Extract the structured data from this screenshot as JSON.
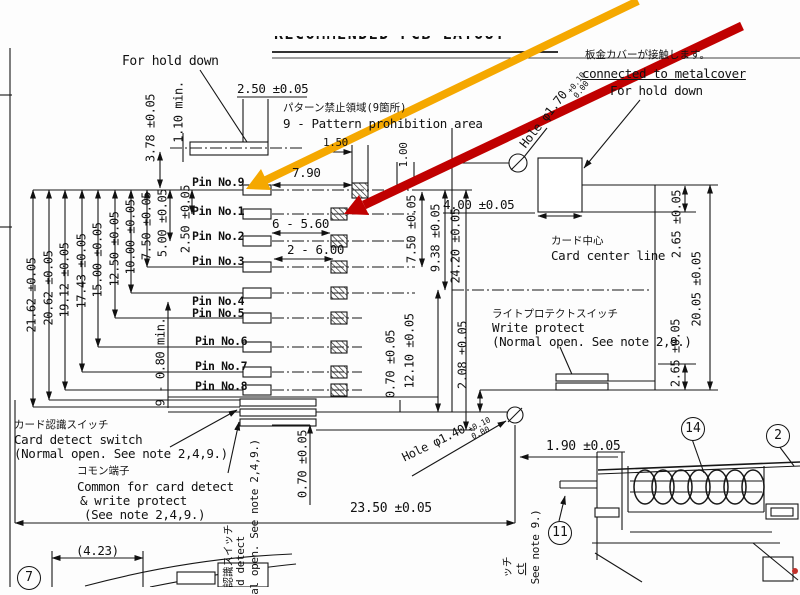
{
  "title": "RECOMMENDED PCB LAYOUT",
  "pins": [
    "Pin No.9",
    "Pin No.1",
    "Pin No.2",
    "Pin No.3",
    "Pin No.4",
    "Pin No.5",
    "Pin No.6",
    "Pin No.7",
    "Pin No.8"
  ],
  "annotations": {
    "hold_down_left": "For hold down",
    "prohibition_jp": "パターン禁止領域(9箇所)",
    "prohibition_en": "9 - Pattern prohibition area",
    "metalcover_jp": "板金カバーが接触します。",
    "metalcover_en": "connected to metalcover",
    "hold_down_right": "For hold down",
    "card_center_jp": "カード中心",
    "card_center_en": "Card center line",
    "write_protect_jp": "ライトプロテクトスイッチ",
    "write_protect_en": "Write protect",
    "write_protect_note": "(Normal open.  See note 2,9.)",
    "card_detect_jp": "カード認識スイッチ",
    "card_detect_en": "Card detect switch",
    "card_detect_note": "(Normal open.  See note 2,4,9.)",
    "common_jp": "コモン端子",
    "common_en1": "Common for card detect",
    "common_en2": "& write protect",
    "common_note": "(See note 2,4,9.)",
    "clip_left_1": "認識スイッチ",
    "clip_left_2": "d detect",
    "clip_left_3": "al open. See note 2,4,9.)",
    "clip_right_1": "ッチ",
    "clip_right_2": "ct",
    "clip_right_3": "See note 9.)"
  },
  "dims": {
    "pad_w": "2.50 ±0.05",
    "h378": "3.78 ±0.05",
    "m110": "1.10 min.",
    "g150": "1.50",
    "g100": "1.00",
    "g790": "7.90",
    "g6560": "6 - 5.60",
    "g2600": "2 - 6.00",
    "l2162": "21.62 ±0.05",
    "l2062": "20.62 ±0.05",
    "l1912": "19.12 ±0.05",
    "l1743": "17.43 ±0.05",
    "l1500": "15.00 ±0.05",
    "l1250": "12.50 ±0.05",
    "l1000": "10.00 ±0.05",
    "l750": "7.50 ±0.05",
    "l500": "5.00 ±0.05",
    "l250": "2.50 ±0.05",
    "m080": "9 - 0.80 min.",
    "r750": "7.50 ±0.05",
    "r938": "9.38 ±0.05",
    "r2420": "24.20 ±0.05",
    "c070": "0.70 ±0.05",
    "c1210": "12.10 ±0.05",
    "c208": "2.08 ±0.05",
    "t400": "4.00 ±0.05",
    "e265t": "2.65 ±0.05",
    "e2005": "20.05 ±0.05",
    "e265b": "2.65 ±0.05",
    "b070": "0.70 ±0.05",
    "b2350": "23.50 ±0.05",
    "b190": "1.90 ±0.05",
    "b423": "(4.23)"
  },
  "holes": {
    "top_label": "Hole φ1.70",
    "top_tol_plus": "+0.10",
    "top_tol_zero": "0.00",
    "bottom_label": "Hole φ1.40",
    "bottom_tol_plus": "+0.10",
    "bottom_tol_zero": "0.00"
  },
  "callouts": {
    "n14": "14",
    "n2": "2",
    "n11": "11",
    "n7": "7"
  },
  "overlay": {
    "yellow": "#F5A800",
    "red": "#C00000",
    "line": "#161616"
  }
}
